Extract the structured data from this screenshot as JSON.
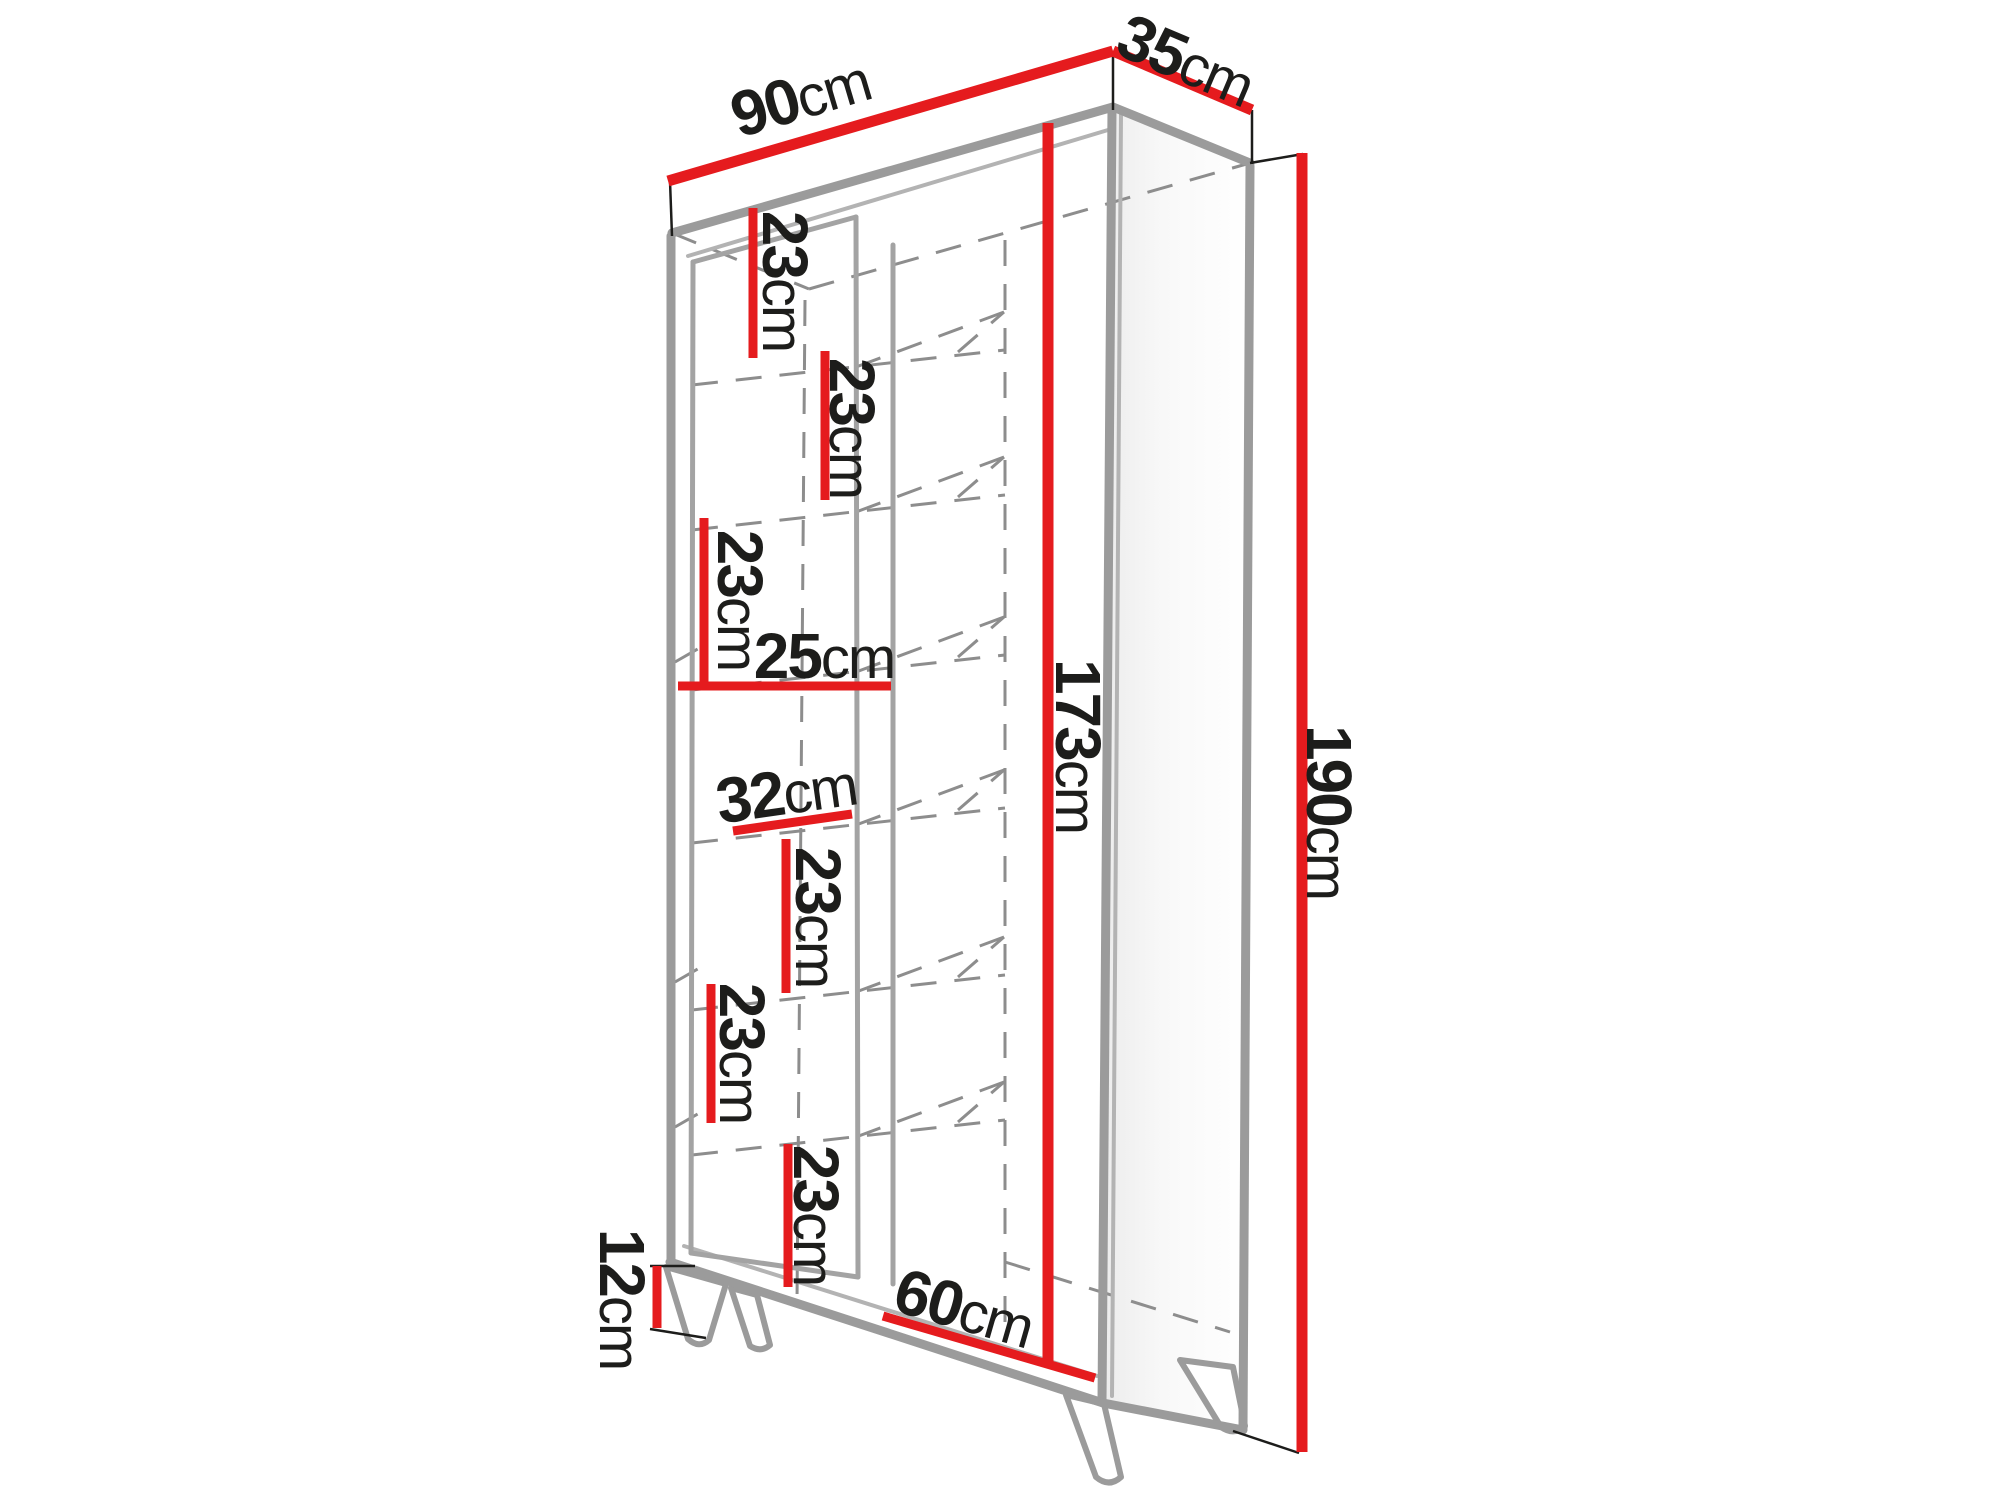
{
  "diagram": {
    "type": "furniture-dimension-diagram",
    "subject": "tall two-door display cabinet on splayed legs, three-quarter view line drawing",
    "unit": "cm",
    "colors": {
      "dimension_line": "#e51b1e",
      "outline_gray": "#9b9b9b",
      "hidden_dashed": "#8d8d8d",
      "label_text": "#1d1d1b",
      "background": "#ffffff"
    },
    "labels": [
      {
        "id": "overall-width",
        "value": "90",
        "unit": "cm"
      },
      {
        "id": "overall-depth",
        "value": "35",
        "unit": "cm"
      },
      {
        "id": "overall-height",
        "value": "190",
        "unit": "cm"
      },
      {
        "id": "carcass-height",
        "value": "173",
        "unit": "cm"
      },
      {
        "id": "shelf-gap-1",
        "value": "23",
        "unit": "cm"
      },
      {
        "id": "shelf-gap-2",
        "value": "23",
        "unit": "cm"
      },
      {
        "id": "shelf-gap-3",
        "value": "23",
        "unit": "cm"
      },
      {
        "id": "shelf-width",
        "value": "25",
        "unit": "cm"
      },
      {
        "id": "shelf-depth",
        "value": "32",
        "unit": "cm"
      },
      {
        "id": "shelf-gap-4",
        "value": "23",
        "unit": "cm"
      },
      {
        "id": "shelf-gap-5",
        "value": "23",
        "unit": "cm"
      },
      {
        "id": "shelf-gap-6",
        "value": "23",
        "unit": "cm"
      },
      {
        "id": "leg-height",
        "value": "12",
        "unit": "cm"
      },
      {
        "id": "bottom-section-width",
        "value": "60",
        "unit": "cm"
      }
    ]
  }
}
